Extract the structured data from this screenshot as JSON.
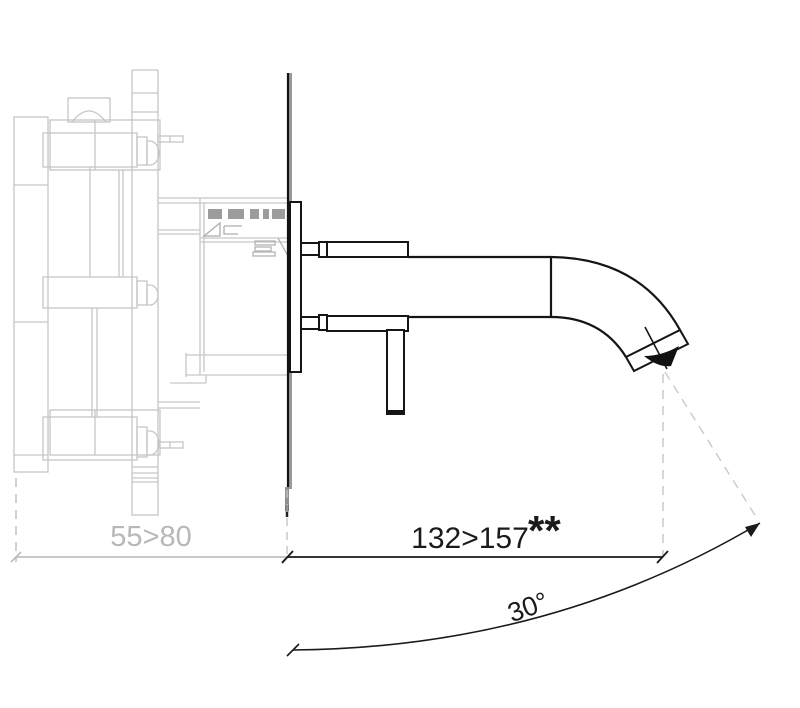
{
  "colors": {
    "ink": "#1a1a1a",
    "ghost": "#c6c6c6",
    "ghost_dark": "#9c9c9c",
    "dim_gray": "#b8b8b8",
    "background": "#ffffff"
  },
  "dimensions": {
    "wall_depth": {
      "label": "55>80"
    },
    "reach": {
      "label": "132>157",
      "suffix": "**"
    },
    "angle": {
      "label": "30°"
    }
  }
}
